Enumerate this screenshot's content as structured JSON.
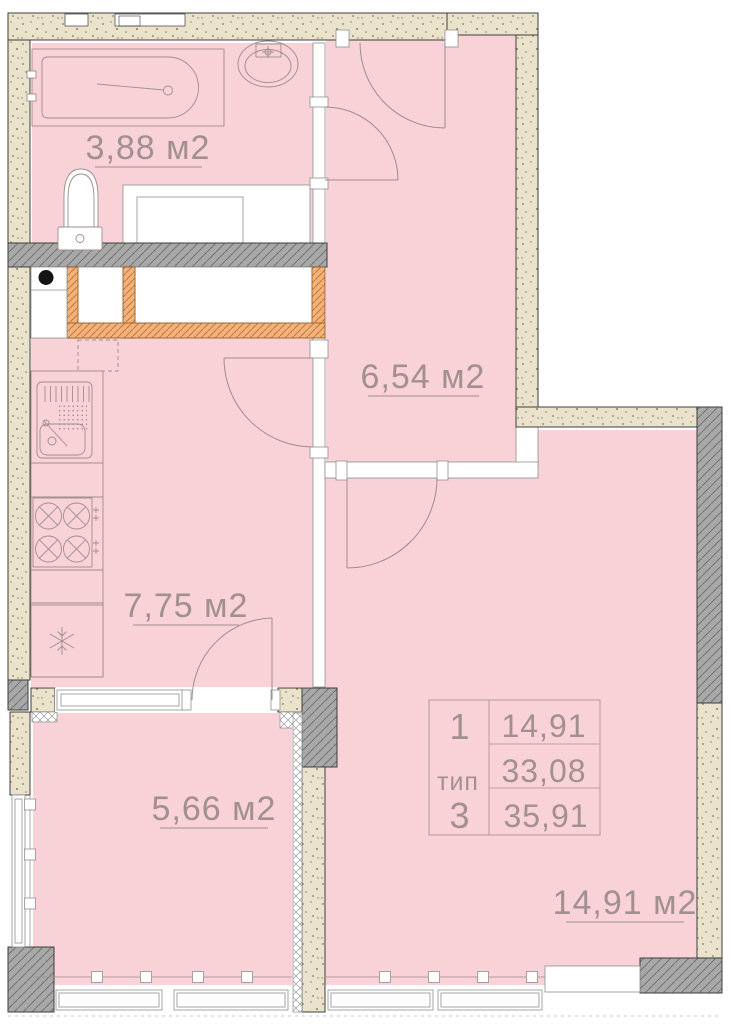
{
  "rooms": [
    {
      "id": "bathroom",
      "label": "3,88 м2"
    },
    {
      "id": "hallway",
      "label": "6,54 м2"
    },
    {
      "id": "kitchen",
      "label": "7,75 м2"
    },
    {
      "id": "balcony",
      "label": "5,66 м2"
    },
    {
      "id": "living-room",
      "label": "14,91 м2"
    }
  ],
  "info_table": {
    "left": [
      "1",
      "тип",
      "3"
    ],
    "right": [
      "14,91",
      "33,08",
      "35,91"
    ]
  },
  "icons": {
    "fridge": "snowflake"
  },
  "colors": {
    "floor": "#f8d2d6",
    "concrete_wall": "#eae2cb",
    "bearing_wall": "#a8a8a8",
    "shaft_wall": "#f3b27c",
    "drawing_line": "#9e8d8d",
    "label_text": "#a18f92"
  }
}
